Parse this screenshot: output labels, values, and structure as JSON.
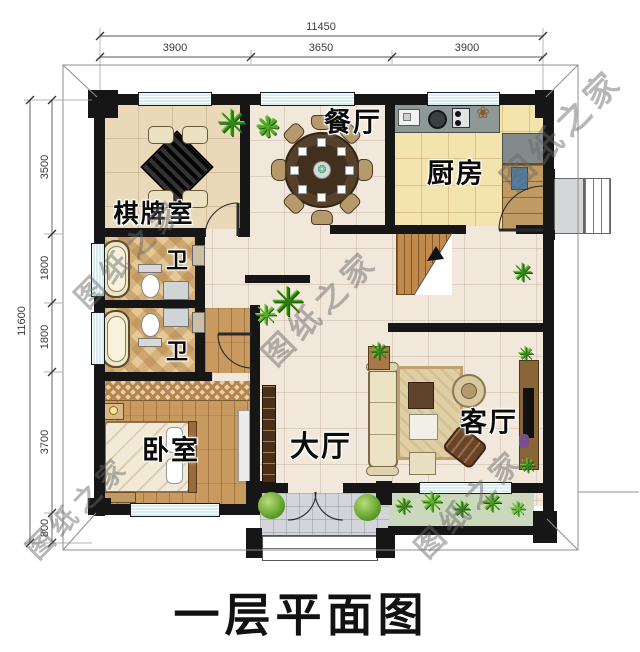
{
  "title": {
    "text": "一层平面图"
  },
  "watermark": {
    "text": "图纸之家"
  },
  "rooms": {
    "dining": {
      "label": "餐厅"
    },
    "kitchen": {
      "label": "厨房"
    },
    "chess": {
      "label": "棋牌室"
    },
    "bath1": {
      "label": "卫"
    },
    "bath2": {
      "label": "卫"
    },
    "bedroom": {
      "label": "卧室"
    },
    "hall": {
      "label": "大厅"
    },
    "living": {
      "label": "客厅"
    }
  },
  "dimensions": {
    "top": {
      "total": "11450",
      "segments": [
        "3900",
        "3650",
        "3900"
      ]
    },
    "left": {
      "total": "11600",
      "segments": [
        "3500",
        "1800",
        "1800",
        "3700",
        "800"
      ]
    }
  },
  "colors": {
    "wall": "#161616",
    "window_fill": "#d6eef2",
    "hall_floor": "#f1e7da",
    "kitchen_floor": "#f3e3ac",
    "wood_floor": "#c99a60"
  }
}
